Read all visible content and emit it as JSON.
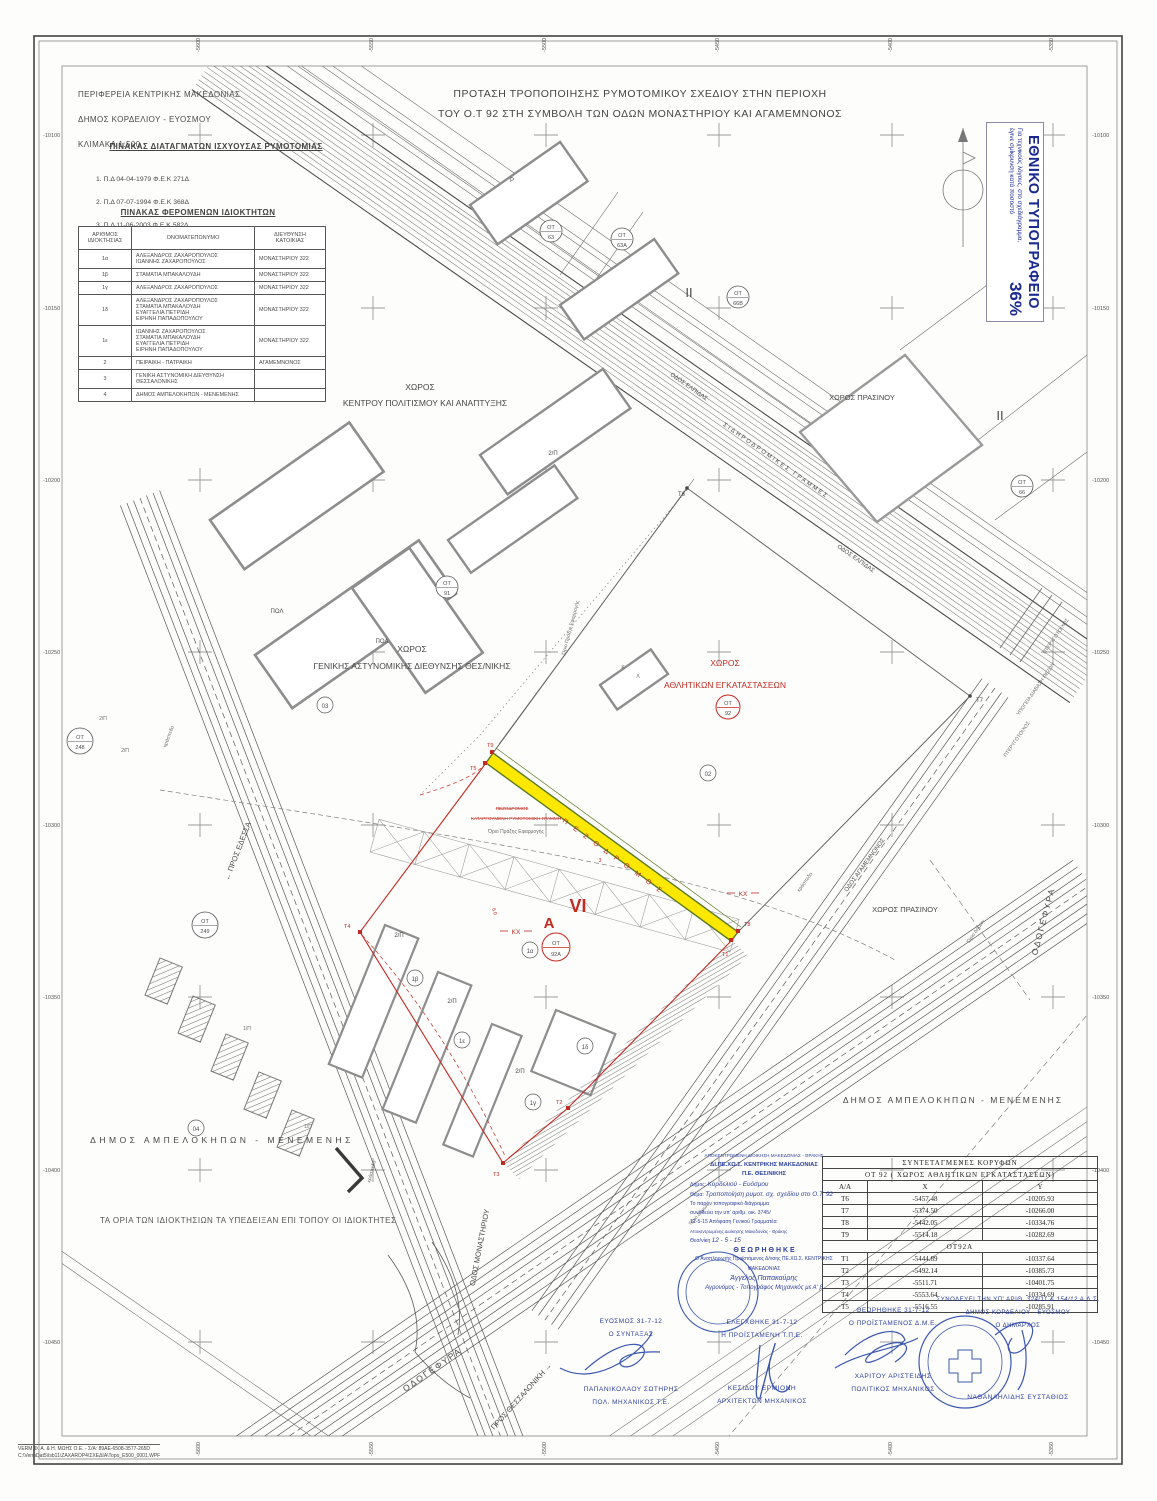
{
  "header": {
    "region": "ΠΕΡΙΦΕΡΕΙΑ ΚΕΝΤΡΙΚΗΣ ΜΑΚΕΔΟΝΙΑΣ",
    "municipality": "ΔΗΜΟΣ ΚΟΡΔΕΛΙΟΥ - ΕΥΟΣΜΟΥ",
    "scale": "ΚΛΙΜΑΚΑ 1:500",
    "title_line1": "ΠΡΟΤΑΣΗ ΤΡΟΠΟΠΟΙΗΣΗΣ ΡΥΜΟΤΟΜΙΚΟΥ ΣΧΕΔΙΟΥ ΣΤΗΝ ΠΕΡΙΟΧΗ",
    "title_line2": "ΤΟΥ Ο.Τ 92 ΣΤΗ ΣΥΜΒΟΛΗ ΤΩΝ ΟΔΩΝ ΜΟΝΑΣΤΗΡΙΟΥ ΚΑΙ ΑΓΑΜΕΜΝΟΝΟΣ"
  },
  "decrees": {
    "title": "ΠΙΝΑΚΑΣ ΔΙΑΤΑΓΜΑΤΩΝ ΙΣΧΥΟΥΣΑΣ ΡΥΜΟΤΟΜΙΑΣ",
    "item1": "1. Π.Δ  04-04-1979   Φ.Ε.Κ 271Δ",
    "item2": "2. Π.Δ  07-07-1994   Φ.Ε.Κ 368Δ",
    "item3": "3. Π.Δ  11-06-2003   Φ.Ε.Κ 582Δ"
  },
  "owners": {
    "title": "ΠΙΝΑΚΑΣ ΦΕΡΟΜΕΝΩΝ ΙΔΙΟΚΤΗΤΩΝ",
    "col1": "ΑΡΙΘΜΟΣ\nΙΔΙΟΚΤΗΣΙΑΣ",
    "col2": "ΟΝΟΜΑΤΕΠΩΝΥΜΟ",
    "col3": "ΔΙΕΥΘΥΝΣΗ\nΚΑΤΟΙΚΙΑΣ",
    "rows": [
      {
        "id": "1α",
        "name": "ΑΛΕΞΑΝΔΡΟΣ ΖΑΧΑΡΟΠΟΥΛΟΣ\nΙΩΑΝΝΗΣ ΖΑΧΑΡΟΠΟΥΛΟΣ",
        "addr": "ΜΟΝΑΣΤΗΡΙΟΥ  322"
      },
      {
        "id": "1β",
        "name": "ΣΤΑΜΑΤΙΑ ΜΠΑΚΑΛΟΥΔΗ",
        "addr": "ΜΟΝΑΣΤΗΡΙΟΥ  322"
      },
      {
        "id": "1γ",
        "name": "ΑΛΕΞΑΝΔΡΟΣ ΖΑΧΑΡΟΠΟΥΛΟΣ",
        "addr": "ΜΟΝΑΣΤΗΡΙΟΥ  322"
      },
      {
        "id": "1δ",
        "name": "ΑΛΕΞΑΝΔΡΟΣ ΖΑΧΑΡΟΠΟΥΛΟΣ\nΣΤΑΜΑΤΙΑ ΜΠΑΚΑΛΟΥΔΗ\nΕΥΑΓΓΕΛΙΑ ΠΕΤΡΙΔΗ\nΕΙΡΗΝΗ ΠΑΠΑΔΟΠΟΥΛΟΥ",
        "addr": "ΜΟΝΑΣΤΗΡΙΟΥ  322"
      },
      {
        "id": "1ε",
        "name": "ΙΩΑΝΝΗΣ ΖΑΧΑΡΟΠΟΥΛΟΣ\nΣΤΑΜΑΤΙΑ ΜΠΑΚΑΛΟΥΔΗ\nΕΥΑΓΓΕΛΙΑ ΠΕΤΡΙΔΗ\nΕΙΡΗΝΗ ΠΑΠΑΔΟΠΟΥΛΟΥ",
        "addr": "ΜΟΝΑΣΤΗΡΙΟΥ  322"
      },
      {
        "id": "2",
        "name": "ΠΕΙΡΑΙΚΗ - ΠΑΤΡΑΙΚΗ",
        "addr": "ΑΓΑΜΕΜΝΟΝΟΣ"
      },
      {
        "id": "3",
        "name": "ΓΕΝΙΚΗ ΑΣΤΥΝΟΜΙΚΗ ΔΙΕΥΘΥΝΣΗ\nΘΕΣΣΑΛΟΝΙΚΗΣ",
        "addr": ""
      },
      {
        "id": "4",
        "name": "ΔΗΜΟΣ ΑΜΠΕΛΟΚΗΠΩΝ - ΜΕΝΕΜΕΝΗΣ",
        "addr": ""
      }
    ]
  },
  "npo": {
    "title": "ΕΘΝΙΚΟ ΤΥΠΟΓΡΑΦΕΙΟ",
    "note1": "Για τεχνικούς λόγους, στο σχεδιάγραμμα,",
    "note2": "έγινε σμίκρυνση κατά ποσοστό",
    "percent": "36%"
  },
  "axis": {
    "top": [
      "-5600",
      "-5550",
      "-5500",
      "-5450",
      "-5400",
      "-5350"
    ],
    "bottom": [
      "-5600",
      "-5550",
      "-5500",
      "-5450",
      "-5400",
      "-5350"
    ],
    "left": [
      "-10100",
      "-10150",
      "-10200",
      "-10250",
      "-10300",
      "-10350",
      "-10400",
      "-10450"
    ],
    "right": [
      "-10100",
      "-10150",
      "-10200",
      "-10250",
      "-10300",
      "-10350",
      "-10400",
      "-10450"
    ]
  },
  "map": {
    "chor": "ΧΩΡΟΣ",
    "kentrou": "ΚΕΝΤΡΟΥ ΠΟΛΙΤΙΣΜΟΥ ΚΑΙ ΑΝΑΠΤΥΞΗΣ",
    "gad": "ΓΕΝΙΚΗΣ ΑΣΤΥΝΟΜΙΚΗΣ ΔΙΕΘΥΝΣΗΣ ΘΕΣ/ΝΙΚΗΣ",
    "athlitikon": "ΑΘΛΗΤΙΚΩΝ ΕΓΚΑΤΑΣΤΑΣΕΩΝ",
    "prasinou": "ΧΩΡΟΣ ΠΡΑΣΙΝΟΥ",
    "ampelokipon": "ΔΗΜΟΣ ΑΜΠΕΛΟΚΗΠΩΝ - ΜΕΝΕΜΕΝΗΣ",
    "sidgrammes": "ΣΙΔΗΡΟΔΡΟΜΙΚΕΣ ΓΡΑΜΜΕΣ",
    "elpidas": "ΟΔΟΣ ΕΛΠΙΔΑΣ",
    "agamemnonos": "ΟΔΟΣ ΑΓΑΜΕΜΝΟΝΟΣ",
    "monastiriou": "ΟΔΟΣ ΜΟΝΑΣΤΗΡΙΟΥ",
    "odogefyra": "ΟΔΟΓΕΦΥΡΑ",
    "pros_edessa": "← ΠΡΟΣ ΕΔΕΣΣΑ",
    "pros_thess": "ΠΡΟΣ ΘΕΣΣΑΛΟΝΙΚΗ →",
    "pterygotoichos": "ΠΤΕΡΥΓΟΤΟΙΧΟΣ",
    "ypogeia": "ΥΠΟΓΕΙΑ ΔΙΑΒΑΣΗ ΠΕΖΩΝ",
    "orio_praxis": "Όριο Πράξης Εφαρμογής",
    "orio_dimon": "Όριο Δήμων",
    "kraspedo": "κράσπεδο",
    "pezodromos": "Π Ε Ζ Ο Δ Ρ Ο Μ Ο Σ",
    "strike1": "ΠΕΖΟΔΡΟΜΟΣ",
    "strike2": "ΚΑΤΑΡΓΟΥΜΕΝΗ ΡΥΜΟΤΟΜΙΚΗ ΓΡΑΜΜΗ",
    "pol": "ΠΟΛ",
    "p": "P",
    "k": "Κ",
    "l": "Λ",
    "ii": "II",
    "a": "Α",
    "vi": "VI",
    "kx": "ΚΧ",
    "ot": "ΟΤ",
    "n63": "63",
    "n63a": "63Α",
    "n66b": "66Β",
    "n66": "66",
    "n91": "91",
    "n248": "248",
    "n249": "249",
    "n92": "92",
    "n92a": "92Α",
    "c02": "02",
    "c03": "03",
    "c04": "04",
    "p1a": "1α",
    "p1b": "1β",
    "p1c": "1γ",
    "p1d": "1δ",
    "p1e": "1ε",
    "b2p": "2/Π",
    "b1p": "1/Π",
    "t1": "Τ1",
    "t2": "Τ2",
    "t3": "Τ3",
    "t4": "Τ4",
    "t5": "Τ5",
    "t6": "Τ6",
    "t7": "Τ7",
    "t8": "Τ8",
    "t9": "Τ9",
    "d50": "5.0",
    "d3": "3"
  },
  "coords": {
    "title": "ΣΥΝΤΕΤΑΓΜΕΝΕΣ   ΚΟΡΥΦΩΝ",
    "subtitle": "ΟΤ 92 ( ΧΩΡΟΣ ΑΘΛΗΤΙΚΩΝ ΕΓΚΑΤΑΣΤΑΣΕΩΝ)",
    "h": [
      "Α/Α",
      "Χ",
      "Υ"
    ],
    "group2": "ΟΤ92Α",
    "rows1": [
      [
        "Τ6",
        "-5457.48",
        "-10205.93"
      ],
      [
        "Τ7",
        "-5374.50",
        "-10266.00"
      ],
      [
        "Τ8",
        "-5442.05",
        "-10334.76"
      ],
      [
        "Τ9",
        "-5514.18",
        "-10282.69"
      ]
    ],
    "rows2": [
      [
        "Τ1",
        "-5444.89",
        "-10337.64"
      ],
      [
        "Τ2",
        "-5492.14",
        "-10385.73"
      ],
      [
        "Τ3",
        "-5511.71",
        "-10401.75"
      ],
      [
        "Τ4",
        "-5553.64",
        "-10334.69"
      ],
      [
        "Τ5",
        "-5516.55",
        "-10285.91"
      ]
    ]
  },
  "note": "ΤΑ ΟΡΙΑ ΤΩΝ ΙΔΙΟΚΤΗΣΙΩΝ ΤΑ ΥΠΕΔΕΙΞΑΝ ΕΠΙ ΤΟΠΟΥ ΟΙ ΙΔΙΟΚΤΗΤΕΣ",
  "approvals": {
    "dipexos": {
      "l1": "ΑΠΟΚΕΝΤΡΩΜΕΝΗ ΔΙΟΙΚΗΣΗ ΜΑΚΕΔΟΝΙΑΣ - ΘΡΑΚΗΣ",
      "l2": "ΔΙ.ΠΕ.ΧΩ.Σ. ΚΕΝΤΡΙΚΗΣ ΜΑΚΕΔΟΝΙΑΣ",
      "l3": "Π.Ε. ΘΕΣ/ΝΙΚΗΣ",
      "dimos_label": "Δήμος:",
      "dimos_value": "Κορδελιού - Ευόσμου",
      "thema_label": "Θέμα:",
      "thema_value": "Τροποποίηση ρυμοτ. σχ. σχεδίου στο Ο.Τ. 92",
      "body1": "Το παρόν τοπογραφικό διάγραμμα",
      "body2": "συνοδεύει την υπ' αριθμ. οικ. 3745/",
      "body3": "12-5-15  Απόφαση Γενικού Γραμματέα",
      "body4": "Αποκεντρωμένης Διοίκησης Μακεδονίας - Θράκης",
      "city_label": "Θεσ/νίκη",
      "city_value": "12 - 5 - 15",
      "theorithike": "Θ Ε Ω Ρ Η Θ Η Κ Ε",
      "role": "Ο Αναπληρωτής Προϊστάμενος Δ/νσης ΠΕ.ΧΩ.Σ. ΚΕΝΤΡΙΚΗΣ ΜΑΚΕΔΟΝΙΑΣ",
      "name": "Άγγελος Παπακαύρης",
      "title": "Αγρονόμος - Τοπογράφος Μηχανικός με Α' β"
    },
    "author": {
      "l1": "ΕΥΟΣΜΟΣ 31-7-12",
      "l2": "Ο ΣΥΝΤΑΞΑΣ",
      "name": "ΠΑΠΑΝΙΚΟΛΑΟΥ ΣΩΤΗΡΗΣ",
      "title": "ΠΟΛ. ΜΗΧΑΝΙΚΟΣ  Τ.Ε."
    },
    "checked": {
      "l1": "ΕΛΕΓΧΘΗΚΕ 31-7-12",
      "l2": "Η ΠΡΟΪΣΤΑΜΕΝΗ Τ.Π.Ε.",
      "name": "ΚΕΣΙΔΟΥ ΕΡΜΙΟΝΗ",
      "title": "ΑΡΧΙΤΕΚΤΩΝ ΜΗΧΑΝΙΚΟΣ"
    },
    "approved": {
      "l1": "ΘΕΩΡΗΘΗΚΕ 31-7-12",
      "l2": "Ο ΠΡΟΪΣΤΑΜΕΝΟΣ Δ.Μ.Ε.",
      "name": "ΧΑΡΙΤΟΥ ΑΡΙΣΤΕΙΔΗΣ",
      "title": "ΠΟΛΙΤΙΚΟΣ ΜΗΧΑΝΙΚΟΣ"
    },
    "mayor": {
      "l1": "ΣΥΝΟΔΕΥΕΙ ΤΗΝ ΥΠ' ΑΡΙΘ.",
      "ref": "324/11 & 154/12",
      "l1b": "Α.Δ.Σ.",
      "l2": "ΔΗΜΟΣ ΚΟΡΔΕΛΙΟΥ - ΕΥΟΣΜΟΥ",
      "l3": "Ο ΔΗΜΑΡΧΟΣ",
      "name": "ΝΑΘΑΝΑΗΛΙΔΗΣ ΕΥΣΤΑΘΙΟΣ"
    }
  },
  "footer": {
    "line1": "VERM Φ. Α. & Η. ΜΩΗΣ Ο.Ε. - Σ/Α: 89ΑΕ-6508-3577-265D",
    "line2": "C:\\VermDat5\\Isb11\\ZAXAROP4\\ΣΧΕΔΙΑ\\Topo_E500_0001.WPF"
  }
}
